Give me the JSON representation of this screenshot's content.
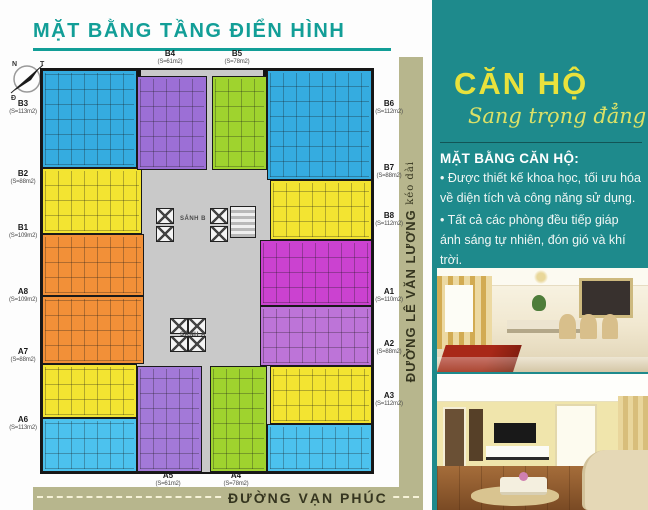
{
  "header": {
    "title": "MẶT BẰNG TẦNG ĐIỂN HÌNH"
  },
  "compass": {
    "top_left": "N",
    "top_right": "T",
    "bottom_left": "Đ",
    "bottom_right": "B"
  },
  "floorplan": {
    "lobby_upper": "SẢNH B",
    "lobby_lower": "SẢNH A",
    "units": [
      {
        "id": "B1",
        "area": "(S=109m2)",
        "color": "#f29038",
        "rect": {
          "x": 0,
          "y": 164,
          "w": 102,
          "h": 62
        },
        "label": {
          "x": 6,
          "y": 224
        }
      },
      {
        "id": "B2",
        "area": "(S=88m2)",
        "color": "#f3e431",
        "rect": {
          "x": 0,
          "y": 98,
          "w": 100,
          "h": 66
        },
        "label": {
          "x": 6,
          "y": 170
        }
      },
      {
        "id": "B3",
        "area": "(S=113m2)",
        "color": "#35ace0",
        "rect": {
          "x": 0,
          "y": 0,
          "w": 95,
          "h": 98
        },
        "label": {
          "x": 6,
          "y": 100
        }
      },
      {
        "id": "B4",
        "area": "(S=61m2)",
        "color": "#9c6fd6",
        "rect": {
          "x": 95,
          "y": 6,
          "w": 70,
          "h": 94
        },
        "label": {
          "x": 153,
          "y": 50
        }
      },
      {
        "id": "B5",
        "area": "(S=78m2)",
        "color": "#9fd32e",
        "rect": {
          "x": 170,
          "y": 6,
          "w": 55,
          "h": 94
        },
        "label": {
          "x": 220,
          "y": 50
        }
      },
      {
        "id": "B6",
        "area": "(S=112m2)",
        "color": "#35ace0",
        "rect": {
          "x": 225,
          "y": 0,
          "w": 105,
          "h": 110
        },
        "label": {
          "x": 372,
          "y": 100
        }
      },
      {
        "id": "B7",
        "area": "(S=88m2)",
        "color": "#f3e431",
        "rect": {
          "x": 228,
          "y": 110,
          "w": 102,
          "h": 60
        },
        "label": {
          "x": 372,
          "y": 164
        }
      },
      {
        "id": "B8",
        "area": "(S=112m2)",
        "color": "#cb42d0",
        "rect": {
          "x": 218,
          "y": 170,
          "w": 112,
          "h": 66
        },
        "label": {
          "x": 372,
          "y": 212
        }
      },
      {
        "id": "A1",
        "area": "(S=110m2)",
        "color": "#bd74d8",
        "rect": {
          "x": 218,
          "y": 236,
          "w": 112,
          "h": 60
        },
        "label": {
          "x": 372,
          "y": 288
        }
      },
      {
        "id": "A2",
        "area": "(S=88m2)",
        "color": "#f3e431",
        "rect": {
          "x": 228,
          "y": 296,
          "w": 102,
          "h": 58
        },
        "label": {
          "x": 372,
          "y": 340
        }
      },
      {
        "id": "A3",
        "area": "(S=112m2)",
        "color": "#4cc2ee",
        "rect": {
          "x": 225,
          "y": 354,
          "w": 105,
          "h": 48
        },
        "label": {
          "x": 372,
          "y": 392
        }
      },
      {
        "id": "A4",
        "area": "(S=78m2)",
        "color": "#9fd32e",
        "rect": {
          "x": 168,
          "y": 296,
          "w": 57,
          "h": 106
        },
        "label": {
          "x": 219,
          "y": 472
        }
      },
      {
        "id": "A5",
        "area": "(S=61m2)",
        "color": "#a379d8",
        "rect": {
          "x": 95,
          "y": 296,
          "w": 65,
          "h": 106
        },
        "label": {
          "x": 151,
          "y": 472
        }
      },
      {
        "id": "A6",
        "area": "(S=113m2)",
        "color": "#4cc2ee",
        "rect": {
          "x": 0,
          "y": 348,
          "w": 95,
          "h": 54
        },
        "label": {
          "x": 6,
          "y": 416
        }
      },
      {
        "id": "A7",
        "area": "(S=88m2)",
        "color": "#f3e431",
        "rect": {
          "x": 0,
          "y": 294,
          "w": 95,
          "h": 54
        },
        "label": {
          "x": 6,
          "y": 348
        }
      },
      {
        "id": "A8",
        "area": "(S=109m2)",
        "color": "#f29038",
        "rect": {
          "x": 0,
          "y": 226,
          "w": 102,
          "h": 68
        },
        "label": {
          "x": 6,
          "y": 288
        }
      }
    ],
    "roads": {
      "side_name": "ĐƯỜNG LÊ VĂN LƯƠNG",
      "side_suffix": "kéo dài",
      "bottom_name": "ĐƯỜNG VẠN PHÚC"
    }
  },
  "panel": {
    "brand_title": "CĂN HỘ",
    "brand_tagline": "Sang trọng đẳng cấp",
    "section_title": "MẶT BẰNG CĂN HỘ:",
    "bullets": [
      "Được thiết kế khoa học, tối ưu hóa về diện tích và công năng sử dụng.",
      "Tất cả các phòng đều tiếp giáp ánh sáng tự nhiên, đón gió và khí trời."
    ],
    "photos": [
      "dining-room-photo",
      "living-room-photo"
    ]
  },
  "colors": {
    "panel_teal": "#1e8a8c",
    "title_teal": "#129e97",
    "road_olive": "#b7b68d",
    "road_text": "#35351f",
    "brand_yellow": "#e9e23c",
    "tagline_yellow": "#dce167"
  }
}
